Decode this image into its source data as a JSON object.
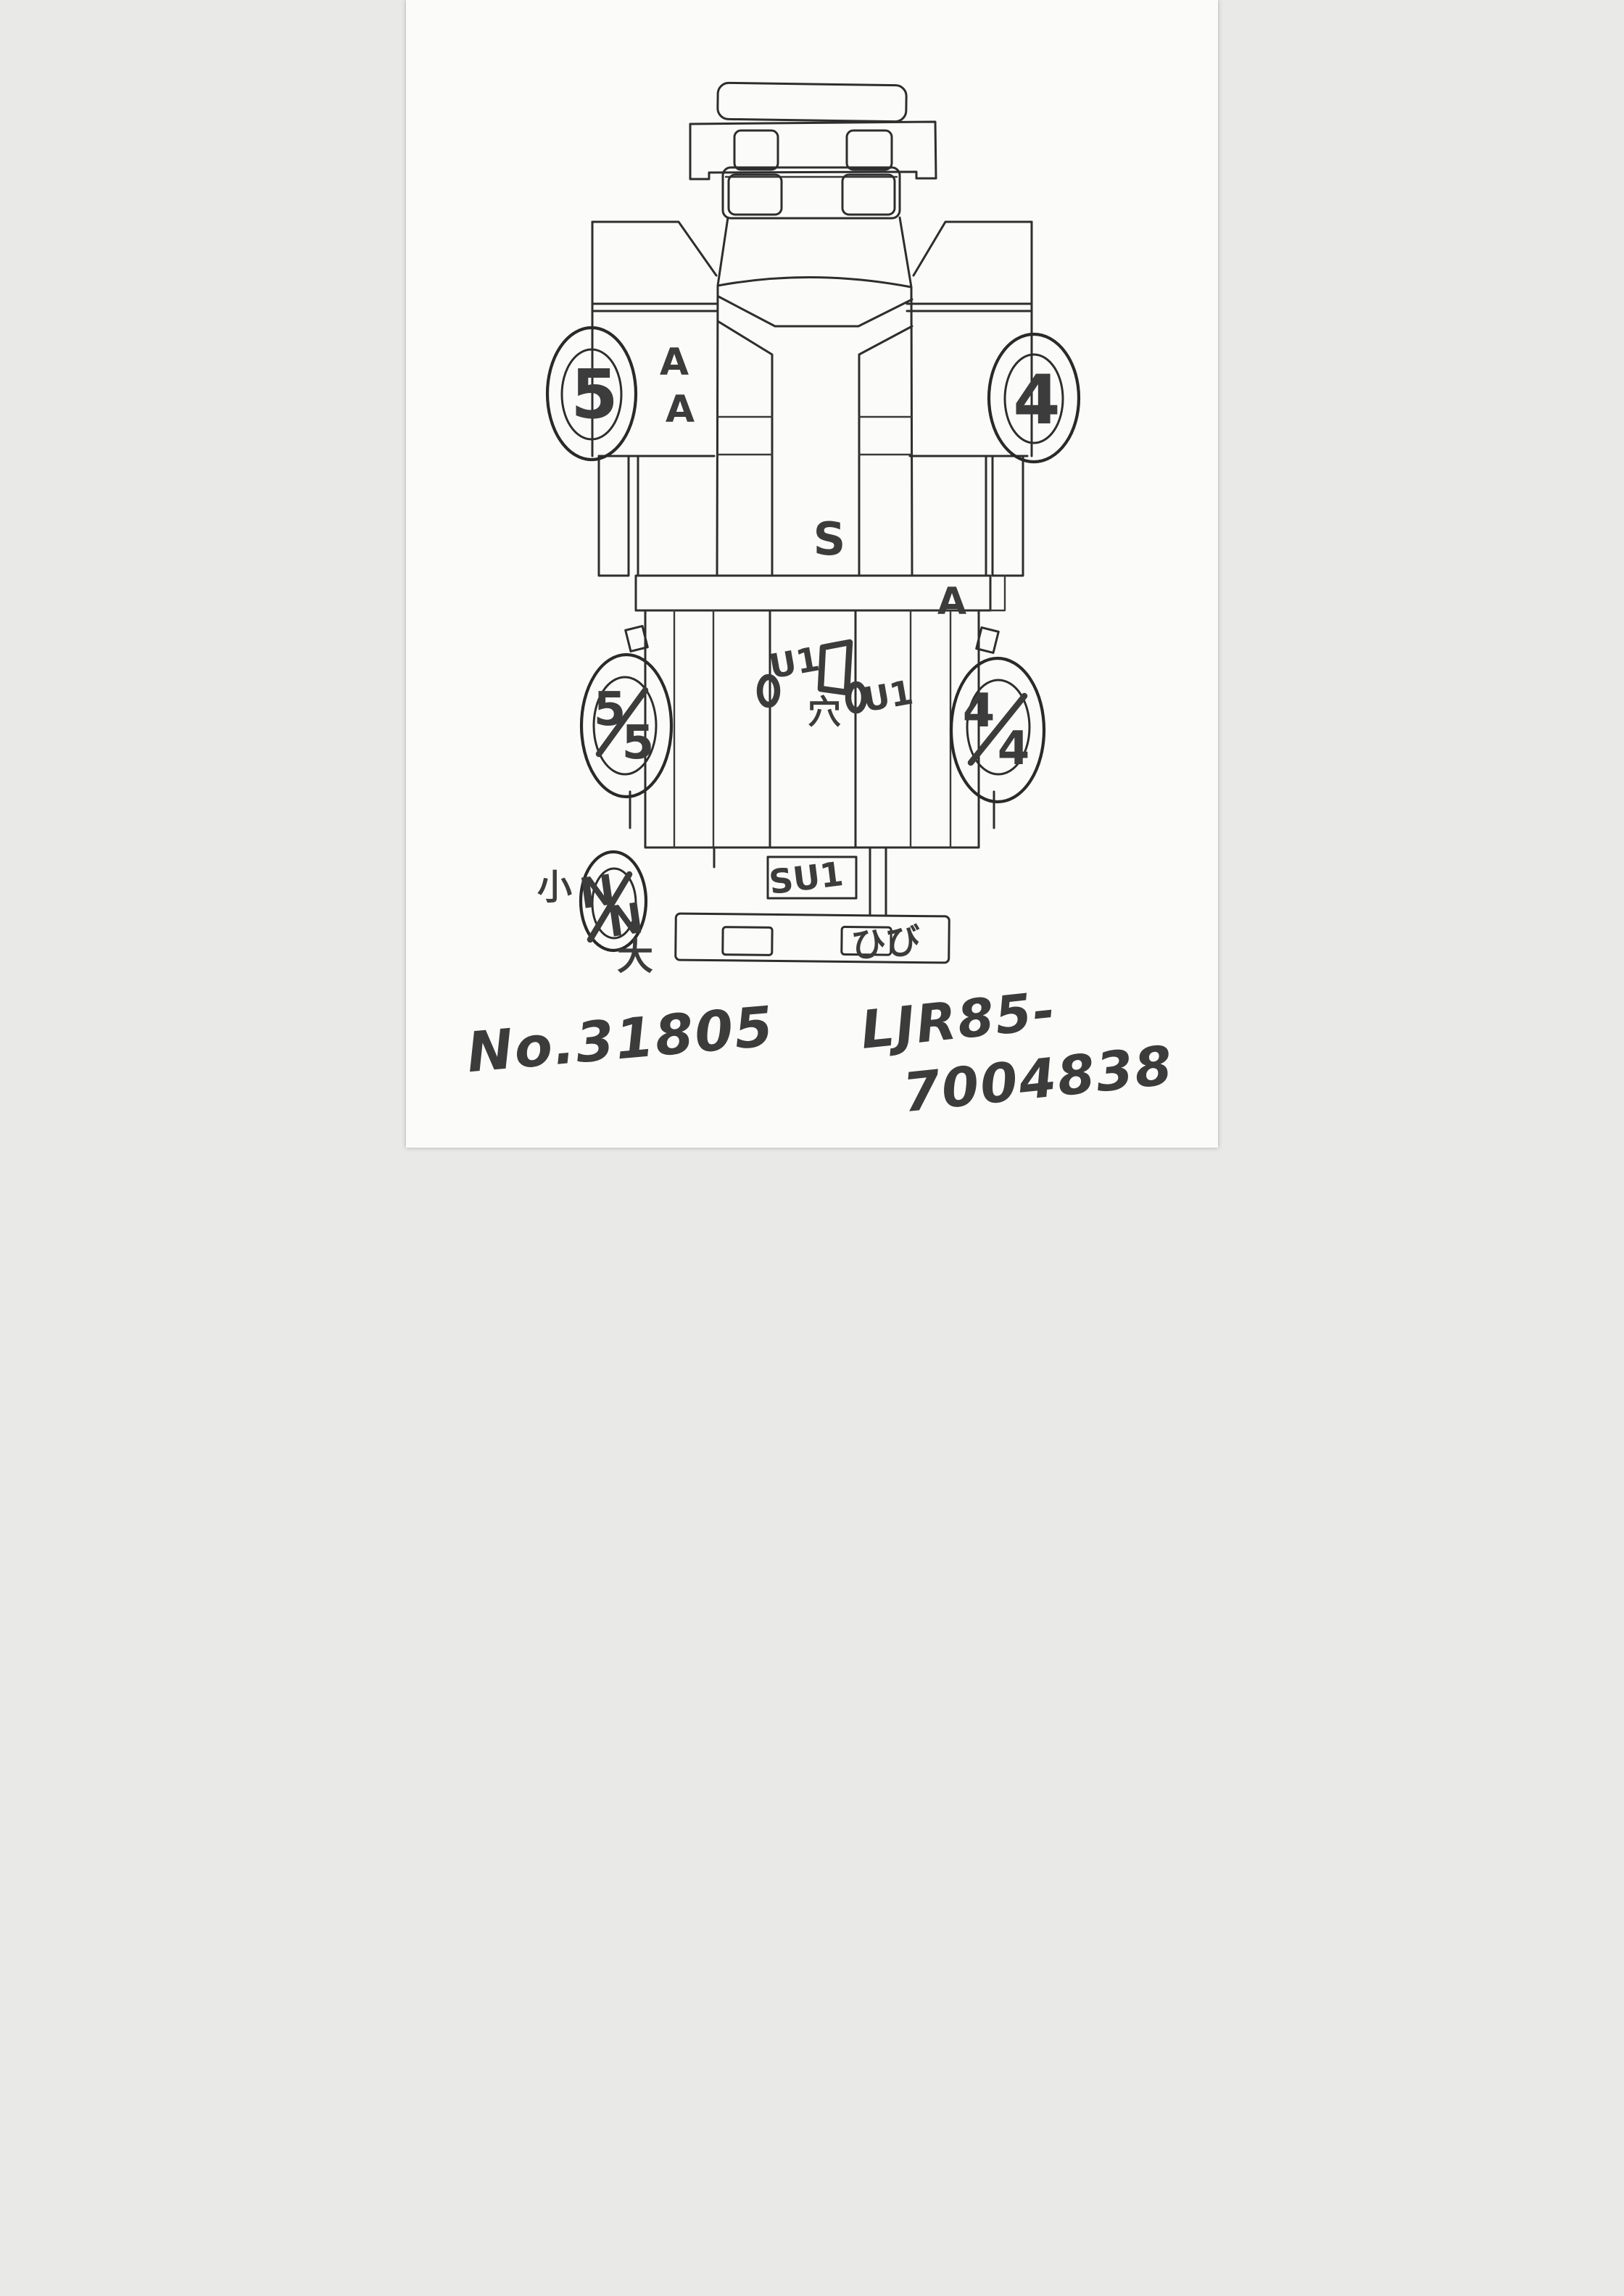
{
  "palette": {
    "paper": "#fbfbf9",
    "ink": "#2e2e2e",
    "marker": "#3c3c3c"
  },
  "diagram": {
    "type": "hand-drawn truck plan-view damage sketch",
    "wheels": {
      "front_left": {
        "label": "5"
      },
      "front_right": {
        "label": "4"
      },
      "rear_left": {
        "label": "5/5",
        "top": "5",
        "bottom": "5"
      },
      "rear_right": {
        "label": "4/4",
        "top": "4",
        "bottom": "4"
      },
      "spare": {
        "label": "N/N",
        "top": "N",
        "bottom": "N"
      }
    },
    "marks": {
      "door_left_1": "A",
      "door_left_2": "A",
      "cab_center": "S",
      "crossmember_right": "A",
      "frame_left": "U1",
      "frame_right": "U1",
      "hole": "穴",
      "spare_small": "小",
      "spare_large": "大",
      "rear_panel": "SU1",
      "bumper_crack": "ひび"
    }
  },
  "footer": {
    "sheet_no": "No.31805",
    "code_line1": "LJR85-",
    "code_line2": "7004838"
  }
}
